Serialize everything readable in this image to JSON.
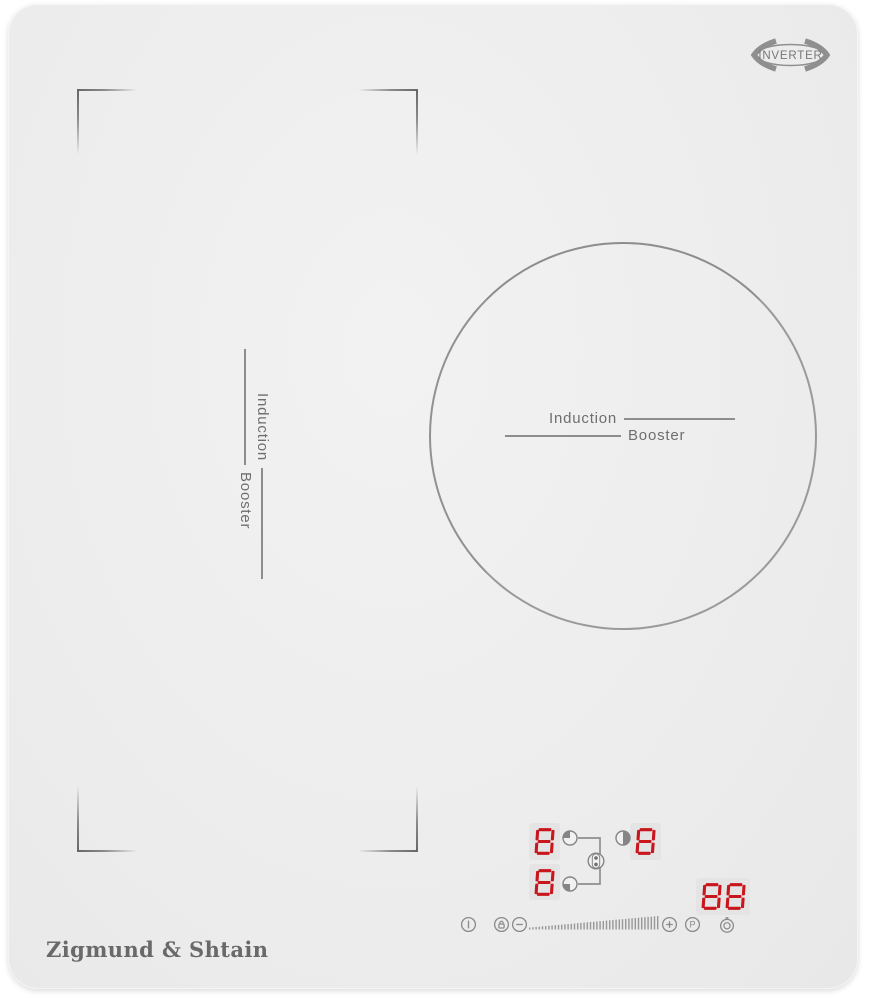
{
  "badge": {
    "label": "INVERTER"
  },
  "zone_labels": {
    "left": {
      "line1": "Induction",
      "line2": "Booster"
    },
    "right": {
      "line1": "Induction",
      "line2": "Booster"
    }
  },
  "displays": {
    "rear_left": "8",
    "front_left": "8",
    "right": "8",
    "timer": "88"
  },
  "indicators": {
    "rear_left_zone_icon": "quarter-circle-top-left",
    "front_left_zone_icon": "quarter-circle-bottom-left",
    "right_zone_icon": "half-circle-right",
    "bridge_icon": "bridge-link-dots"
  },
  "controls": [
    {
      "id": "power",
      "icon": "power-icon"
    },
    {
      "id": "lock",
      "icon": "lock-icon"
    },
    {
      "id": "minus",
      "icon": "minus-icon"
    },
    {
      "id": "slider",
      "icon": "slider-ticks"
    },
    {
      "id": "plus",
      "icon": "plus-icon"
    },
    {
      "id": "p",
      "icon": "p-letter",
      "label": "P"
    },
    {
      "id": "timer",
      "icon": "timer-clock-icon"
    }
  ],
  "brand": {
    "logo": "Zigmund & Shtain"
  },
  "colors": {
    "digit_red": "#c9151c",
    "icon_gray": "#8a8a8a",
    "line_gray": "#8d8d8d",
    "panel_gray": "#ececec"
  }
}
